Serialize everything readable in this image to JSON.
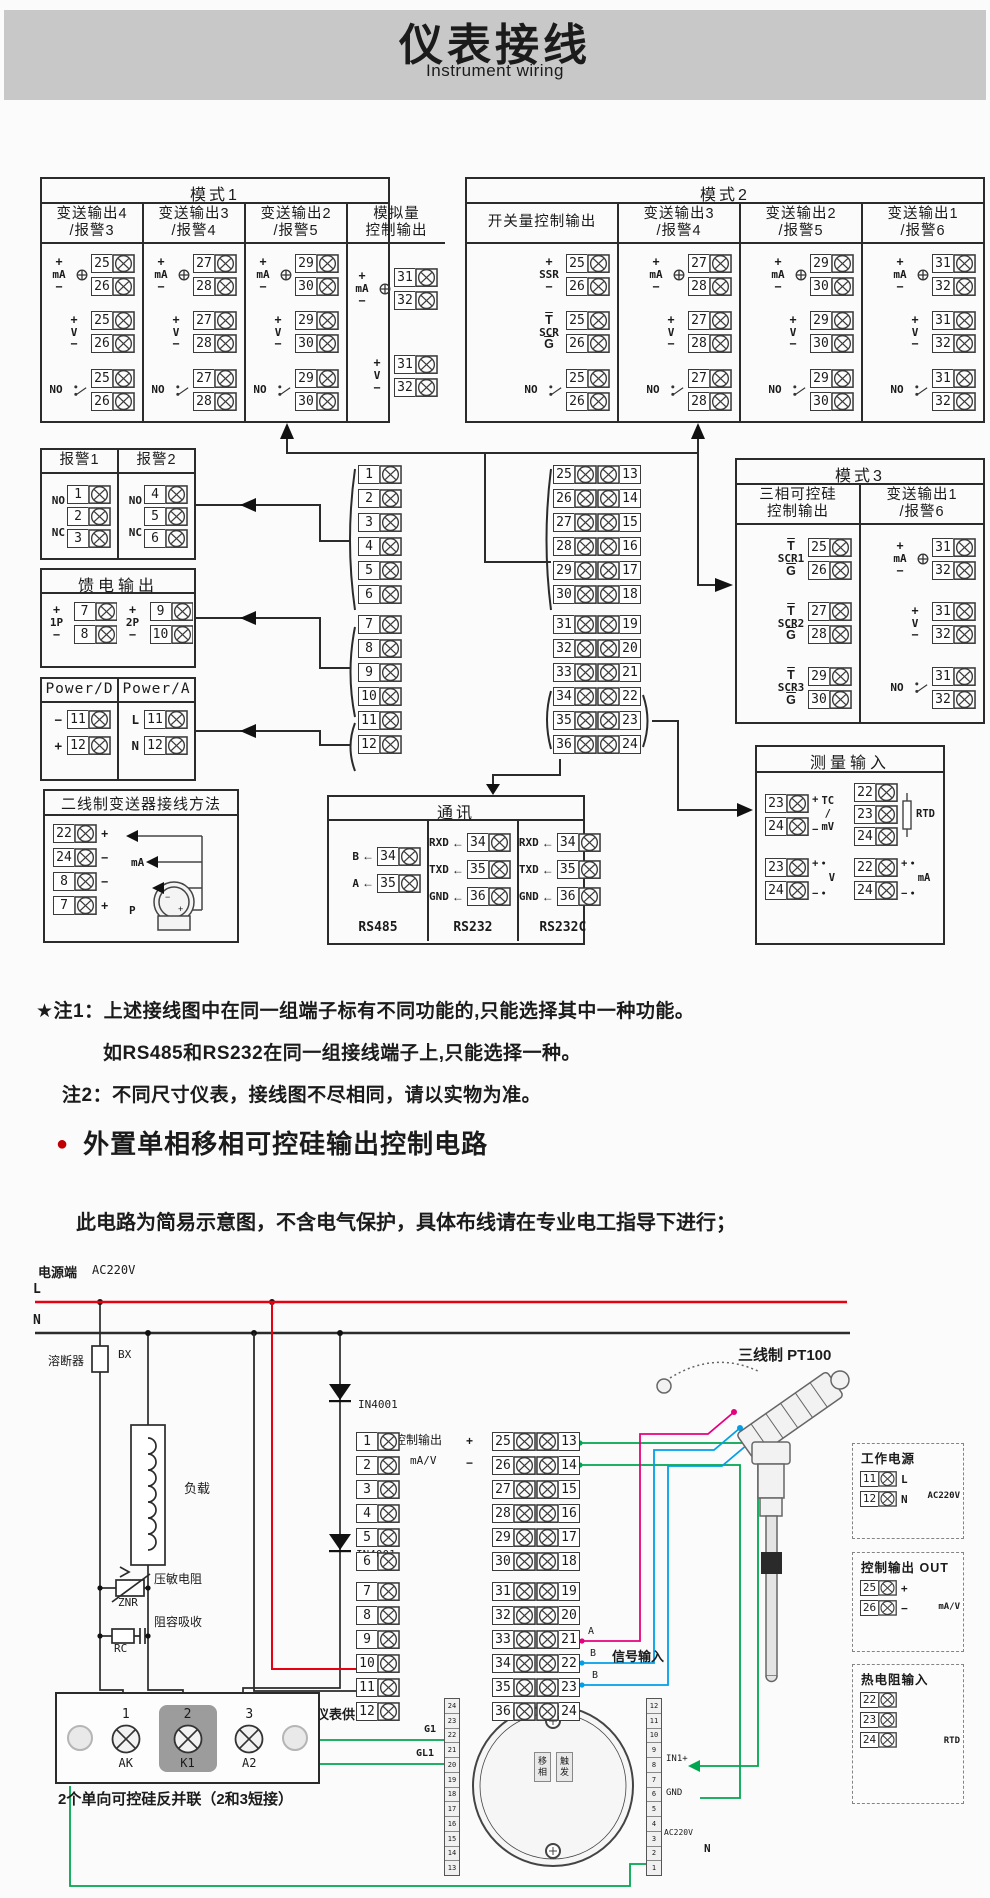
{
  "header": {
    "title": "仪表接线",
    "subtitle": "Instrument wiring"
  },
  "mode1": {
    "title": "模式1",
    "columns": [
      {
        "title": "变送输出4",
        "sub": "/报警3",
        "w": "1",
        "rows": [
          {
            "m1": "+",
            "label": "mA",
            "m2": "−",
            "cur": true,
            "t": [
              25,
              26
            ]
          },
          {
            "m1": "+",
            "label": "V",
            "m2": "−",
            "t": [
              25,
              26
            ]
          },
          {
            "label": "NO",
            "sw": true,
            "t": [
              25,
              26
            ]
          }
        ]
      },
      {
        "title": "变送输出3",
        "sub": "/报警4",
        "w": "1",
        "rows": [
          {
            "m1": "+",
            "label": "mA",
            "m2": "−",
            "cur": true,
            "t": [
              27,
              28
            ]
          },
          {
            "m1": "+",
            "label": "V",
            "m2": "−",
            "t": [
              27,
              28
            ]
          },
          {
            "label": "NO",
            "sw": true,
            "t": [
              27,
              28
            ]
          }
        ]
      },
      {
        "title": "变送输出2",
        "sub": "/报警5",
        "w": "1",
        "rows": [
          {
            "m1": "+",
            "label": "mA",
            "m2": "−",
            "cur": true,
            "t": [
              29,
              30
            ]
          },
          {
            "m1": "+",
            "label": "V",
            "m2": "−",
            "t": [
              29,
              30
            ]
          },
          {
            "label": "NO",
            "sw": true,
            "t": [
              29,
              30
            ]
          }
        ]
      },
      {
        "title": "模拟量",
        "sub": "控制输出",
        "w": "1.15",
        "rows": [
          {
            "m1": "+",
            "label": "mA",
            "m2": "−",
            "cur": true,
            "t": [
              31,
              32
            ]
          },
          {
            "m1": "+",
            "label": "V",
            "m2": "−",
            "t": [
              31,
              32
            ]
          }
        ]
      }
    ]
  },
  "mode2": {
    "title": "模式2",
    "columns": [
      {
        "title": "开关量控制输出",
        "sub": "",
        "w": "1.25",
        "rows": [
          {
            "m1": "+",
            "label": "SSR",
            "m2": "−",
            "t": [
              25,
              26
            ]
          },
          {
            "m1": "T",
            "label": "SCR",
            "m2": "G",
            "ovl": true,
            "t": [
              25,
              26
            ]
          },
          {
            "label": "NO",
            "sw": true,
            "t": [
              25,
              26
            ]
          }
        ]
      },
      {
        "title": "变送输出3",
        "sub": "/报警4",
        "w": "1",
        "rows": [
          {
            "m1": "+",
            "label": "mA",
            "m2": "−",
            "cur": true,
            "t": [
              27,
              28
            ]
          },
          {
            "m1": "+",
            "label": "V",
            "m2": "−",
            "t": [
              27,
              28
            ]
          },
          {
            "label": "NO",
            "sw": true,
            "t": [
              27,
              28
            ]
          }
        ]
      },
      {
        "title": "变送输出2",
        "sub": "/报警5",
        "w": "1",
        "rows": [
          {
            "m1": "+",
            "label": "mA",
            "m2": "−",
            "cur": true,
            "t": [
              29,
              30
            ]
          },
          {
            "m1": "+",
            "label": "V",
            "m2": "−",
            "t": [
              29,
              30
            ]
          },
          {
            "label": "NO",
            "sw": true,
            "t": [
              29,
              30
            ]
          }
        ]
      },
      {
        "title": "变送输出1",
        "sub": "/报警6",
        "w": "1",
        "rows": [
          {
            "m1": "+",
            "label": "mA",
            "m2": "−",
            "cur": true,
            "t": [
              31,
              32
            ]
          },
          {
            "m1": "+",
            "label": "V",
            "m2": "−",
            "t": [
              31,
              32
            ]
          },
          {
            "label": "NO",
            "sw": true,
            "t": [
              31,
              32
            ]
          }
        ]
      }
    ]
  },
  "mode3": {
    "title": "模式3",
    "columns": [
      {
        "title": "三相可控硅",
        "sub": "控制输出",
        "w": "1",
        "rows": [
          {
            "m1": "T",
            "label": "SCR1",
            "m2": "G",
            "ovl": true,
            "t": [
              25,
              26
            ]
          },
          {
            "m1": "T",
            "label": "SCR2",
            "m2": "G",
            "ovl": true,
            "t": [
              27,
              28
            ]
          },
          {
            "m1": "T",
            "label": "SCR3",
            "m2": "G",
            "ovl": true,
            "t": [
              29,
              30
            ]
          }
        ]
      },
      {
        "title": "变送输出1",
        "sub": "/报警6",
        "w": "1",
        "rows": [
          {
            "m1": "+",
            "label": "mA",
            "m2": "−",
            "cur": true,
            "t": [
              31,
              32
            ]
          },
          {
            "m1": "+",
            "label": "V",
            "m2": "−",
            "t": [
              31,
              32
            ]
          },
          {
            "label": "NO",
            "sw": true,
            "t": [
              31,
              32
            ]
          }
        ]
      }
    ]
  },
  "alarms": {
    "columns": [
      {
        "title": "报警1",
        "no": "NO",
        "nc": "NC",
        "t": [
          1,
          2,
          3
        ]
      },
      {
        "title": "报警2",
        "no": "NO",
        "nc": "NC",
        "t": [
          4,
          5,
          6
        ]
      }
    ]
  },
  "feed": {
    "title": "馈电输出",
    "groups": [
      {
        "m1": "+",
        "label": "1P",
        "m2": "−",
        "t": [
          7,
          8
        ]
      },
      {
        "m1": "+",
        "label": "2P",
        "m2": "−",
        "t": [
          9,
          10
        ]
      }
    ]
  },
  "power": {
    "columns": [
      {
        "title": "Power/D",
        "rows": [
          {
            "mark": "−",
            "t": 11
          },
          {
            "mark": "+",
            "t": 12
          }
        ]
      },
      {
        "title": "Power/A",
        "rows": [
          {
            "mark": "L",
            "t": 11
          },
          {
            "mark": "N",
            "t": 12
          }
        ]
      }
    ]
  },
  "twowire": {
    "title": "二线制变送器接线方法",
    "rows": [
      {
        "t": 22,
        "mark": "+"
      },
      {
        "t": 24,
        "mark": "−"
      },
      {
        "t": 8,
        "mark": "−"
      },
      {
        "t": 7,
        "mark": "+"
      }
    ],
    "mid1": "mA",
    "mid2": "P"
  },
  "strip": {
    "left": [
      1,
      2,
      3,
      4,
      5,
      6,
      7,
      8,
      9,
      10,
      11,
      12
    ],
    "right_a": [
      25,
      26,
      27,
      28,
      29,
      30,
      31,
      32,
      33,
      34,
      35,
      36
    ],
    "right_b": [
      13,
      14,
      15,
      16,
      17,
      18,
      19,
      20,
      21,
      22,
      23,
      24
    ]
  },
  "comm": {
    "title": "通讯",
    "groups": [
      {
        "caption": "RS485",
        "w": "100",
        "rows": [
          {
            "label": "B",
            "t": 34
          },
          {
            "label": "A",
            "t": 35
          }
        ]
      },
      {
        "caption": "RS232",
        "w": "76",
        "rows": [
          {
            "label": "RXD",
            "t": 34
          },
          {
            "label": "TXD",
            "t": 35
          },
          {
            "label": "GND",
            "t": 36
          }
        ]
      },
      {
        "caption": "RS232C",
        "w": "77",
        "rows": [
          {
            "label": "RXD",
            "t": 34
          },
          {
            "label": "TXD",
            "t": 35
          },
          {
            "label": "GND",
            "t": 36
          }
        ]
      }
    ]
  },
  "measure": {
    "title": "测量输入",
    "tc": {
      "t": [
        23,
        24
      ],
      "m1": "+",
      "m2": "−",
      "l1": "TC",
      "l2": "/",
      "l3": "mV"
    },
    "rtd": {
      "t": [
        22,
        23,
        24
      ],
      "label": "RTD"
    },
    "v": {
      "t": [
        23,
        24
      ],
      "m1": "+",
      "m2": "−",
      "label": "V"
    },
    "ma": {
      "t": [
        22,
        24
      ],
      "m1": "+",
      "m2": "−",
      "label": "mA"
    }
  },
  "notes": {
    "note1": "★注1：上述接线图中在同一组端子标有不同功能的,只能选择其中一种功能。",
    "note1b": "如RS485和RS232在同一组接线端子上,只能选择一种。",
    "note2": "注2：不同尺寸仪表，接线图不尽相同，请以实物为准。"
  },
  "section2": {
    "bullet": "●",
    "heading": "外置单相移相可控硅输出控制电路",
    "subheading": "此电路为简易示意图，不含电气保护，具体布线请在专业电工指导下进行；"
  },
  "circuit": {
    "power_label": "电源端",
    "voltage": "AC220V",
    "l": "L",
    "n": "N",
    "fuse_label": "溶断器",
    "fuse_code": "BX",
    "load": "负载",
    "varistor_label": "压敏电阻",
    "varistor_code": "ZNR",
    "rc_label": "阻容吸收",
    "rc_code": "RC",
    "diode1": "IN4001",
    "diode2": "IN4001",
    "ctrl_out": "控制输出",
    "ctrl_plus": "+",
    "ctrl_minus": "−",
    "ctrl_unit": "mA/V",
    "meter_supply": "仪表供电",
    "signal_input": "信号输入",
    "sig_a": "A",
    "sig_b1": "B",
    "sig_b2": "B",
    "pt100": "三线制 PT100",
    "g1": "G1",
    "gl1": "GL1",
    "in1": "IN1+",
    "gnd": "GND",
    "ac220": "AC220V",
    "n2": "N",
    "board_text1": "移相",
    "board_text2": "触发",
    "scr_terminals": [
      "1",
      "2",
      "3"
    ],
    "scr_pins": [
      "AK",
      "K1",
      "A2"
    ],
    "scr_caption": "2个单向可控硅反并联（2和3短接）",
    "board_left_pins": [
      "24",
      "23",
      "22",
      "21",
      "20",
      "19",
      "18",
      "17",
      "16",
      "15",
      "14",
      "13"
    ],
    "board_right_pins": [
      "12",
      "11",
      "10",
      "9",
      "8",
      "7",
      "6",
      "5",
      "4",
      "3",
      "2",
      "1"
    ]
  },
  "panel": {
    "b1": {
      "title": "工作电源",
      "side": "AC220V",
      "rows": [
        {
          "t": 11,
          "label": "L"
        },
        {
          "t": 12,
          "label": "N"
        }
      ]
    },
    "b2": {
      "title": "控制输出 OUT",
      "side": "mA/V",
      "rows": [
        {
          "t": 25,
          "label": "+"
        },
        {
          "t": 26,
          "label": "−"
        }
      ]
    },
    "b3": {
      "title": "热电阻输入",
      "side": "RTD",
      "rows": [
        {
          "t": 22,
          "label": ""
        },
        {
          "t": 23,
          "label": ""
        },
        {
          "t": 24,
          "label": ""
        }
      ]
    }
  },
  "colors": {
    "accent_red": "#e60012",
    "green": "#00a651",
    "cyan": "#00a0e9",
    "magenta": "#e6007e",
    "header_gray": "#c8c8c8"
  }
}
